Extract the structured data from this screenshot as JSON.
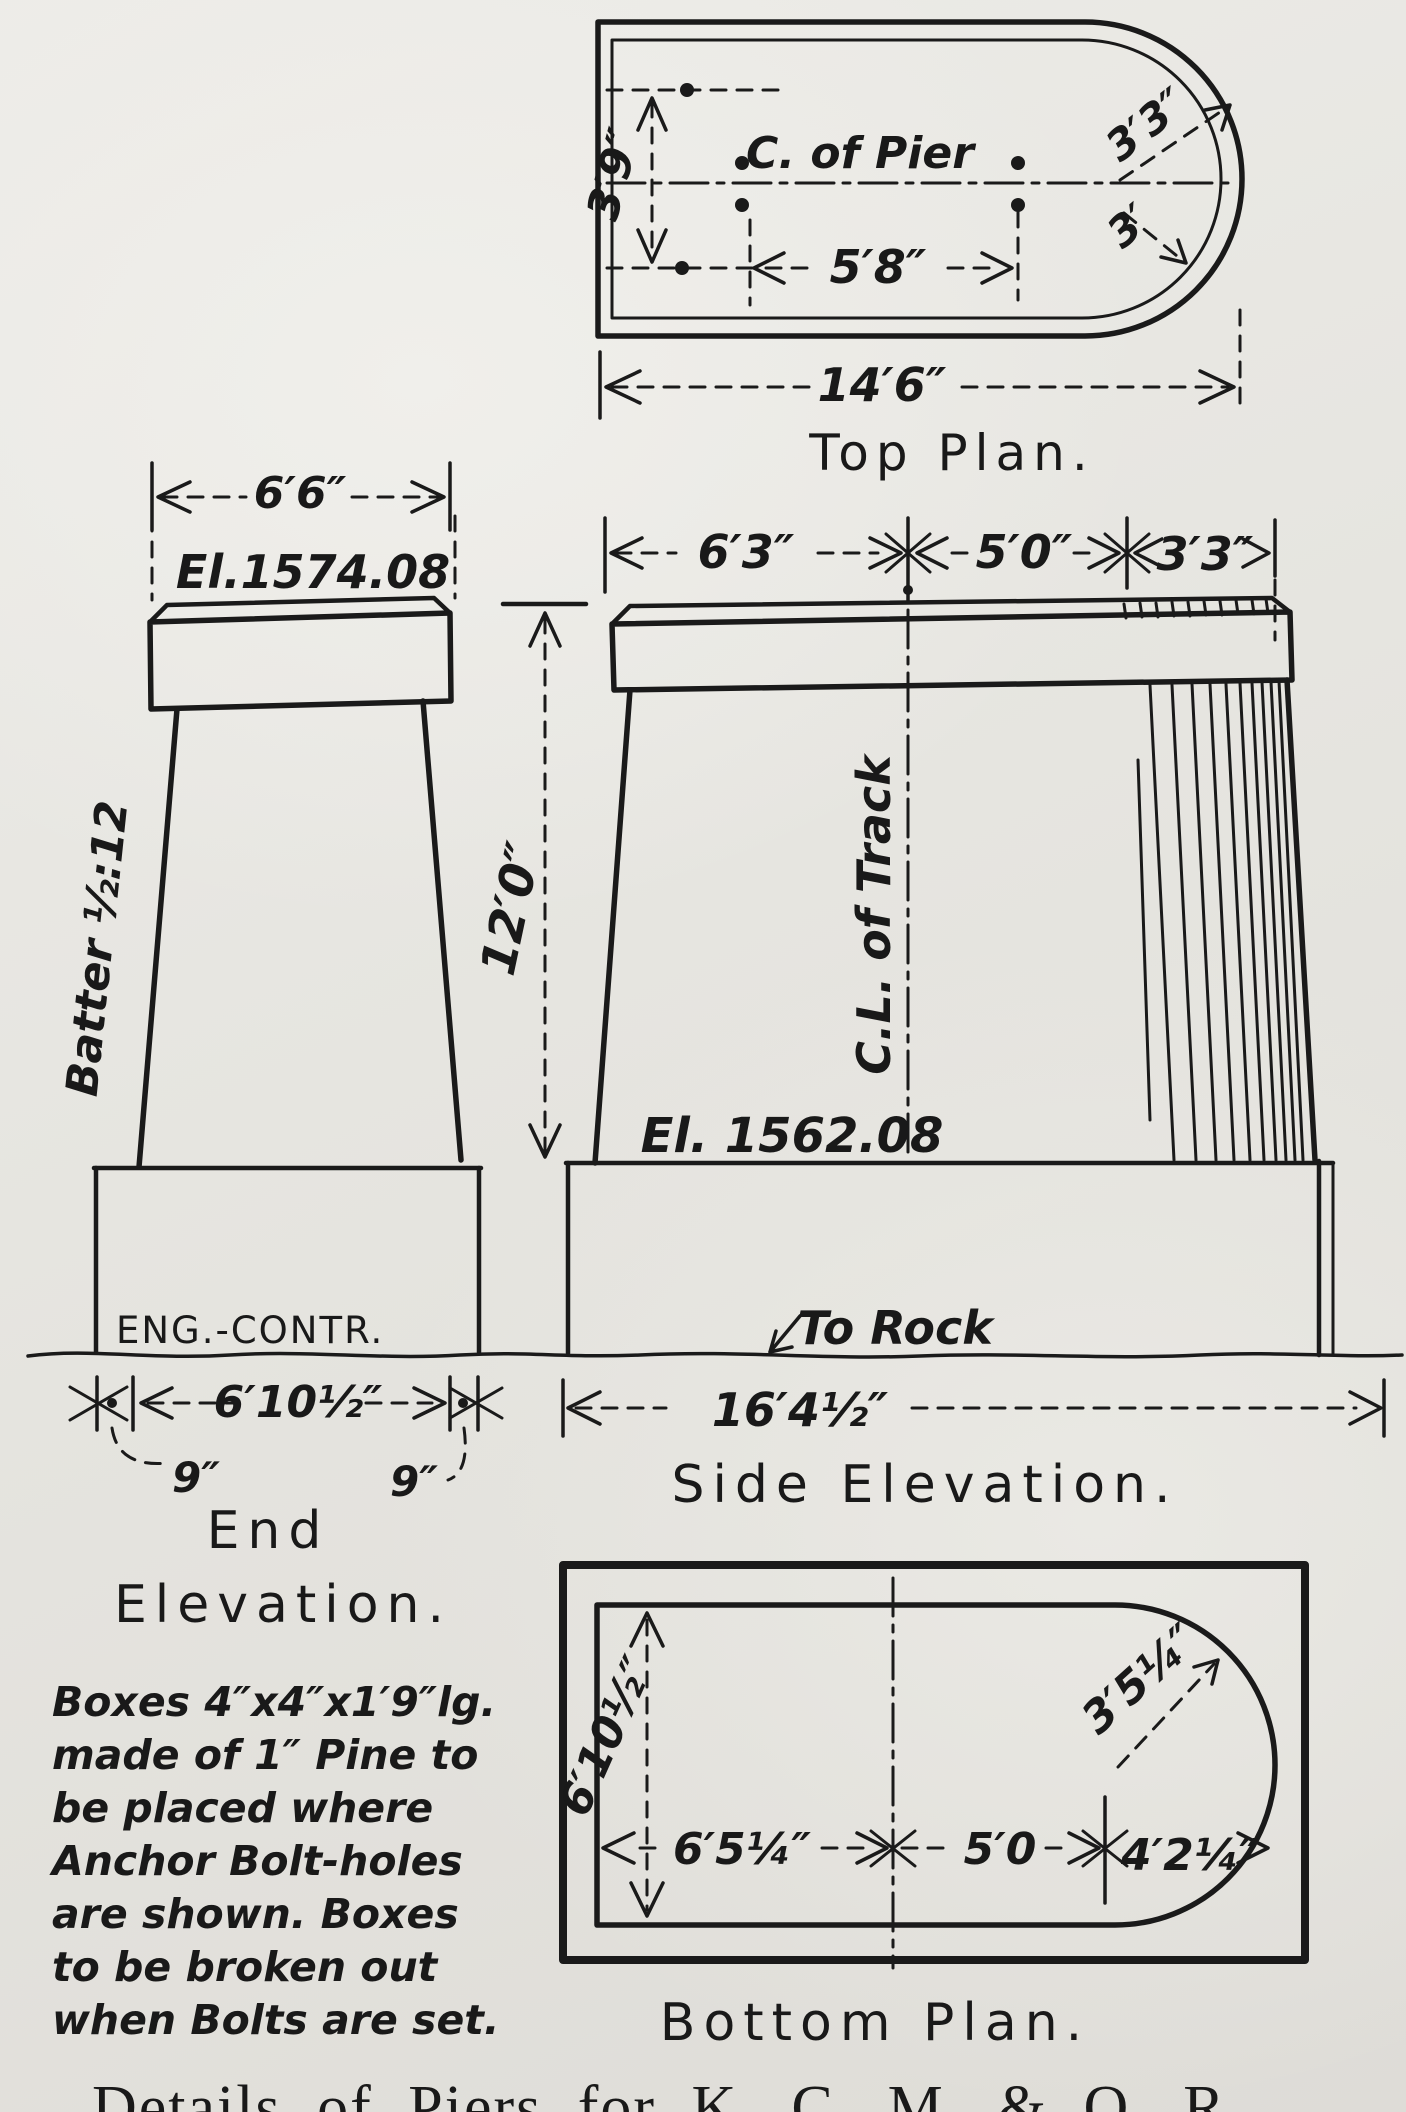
{
  "top_plan": {
    "title": "Top Plan.",
    "center_label": "C. of Pier",
    "width_dim": "3′9″",
    "bolt_dim": "5′8″",
    "radius_outer_dim": "3′3″",
    "radius_inner_dim": "3′",
    "length_dim": "14′6″"
  },
  "end_elevation": {
    "width_dim": "6′6″",
    "elevation_label": "El.1574.08",
    "batter_label": "Batter ½:12",
    "footing_label": "ENG.-CONTR.",
    "footing_dim": "6′10½″",
    "offset_left_dim": "9″",
    "offset_right_dim": "9″",
    "title_line1": "End",
    "title_line2": "Elevation."
  },
  "side_elevation": {
    "seg1_dim": "6′3″",
    "seg2_dim": "5′0″",
    "seg3_dim": "3′3″",
    "height_dim": "12′0″",
    "centerline_label": "C.L. of Track",
    "elevation_label": "El. 1562.08",
    "rock_label": "To Rock",
    "footing_dim": "16′4½″",
    "title": "Side Elevation."
  },
  "bottom_plan": {
    "height_dim": "6′10½″",
    "seg1_dim": "6′5¼″",
    "seg2_dim": "5′0",
    "seg3_dim": "4′2¼″",
    "radius_dim": "3′5¼″",
    "title": "Bottom Plan."
  },
  "notes": {
    "lines": [
      "Boxes 4″x4″x1′9″lg.",
      "made of 1″ Pine to",
      "be placed where",
      "Anchor Bolt-holes",
      "are shown. Boxes",
      "to be broken out",
      "when Bolts are set."
    ]
  },
  "caption": "Details of Piers for K. C. M. & O. R"
}
